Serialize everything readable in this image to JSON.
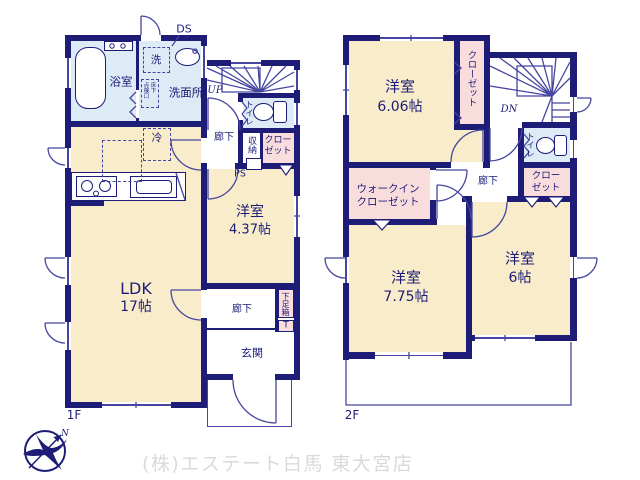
{
  "meta": {
    "floor1_label": "1F",
    "floor2_label": "2F"
  },
  "colors": {
    "wall": "#1d1d78",
    "room_cream": "#f8ecca",
    "wet_blue": "#dcebf6",
    "closet_pink": "#f9dddd",
    "thin_line": "#4646a0",
    "footer_gray": "#dadada"
  },
  "f1": {
    "bath": "浴室",
    "washer": "洗",
    "washroom": "洗面所",
    "duct": "DS",
    "insp_col_left": "点検口",
    "insp_col_right": "床下",
    "stairs_up": "UP",
    "toilet": "トイレ",
    "hall_upper": "廊下",
    "storage": "収納",
    "closet_line1": "クロー",
    "closet_line2": "ゼット",
    "pipe_space": "PS",
    "fridge": "冷",
    "ldk_name": "LDK",
    "ldk_size": "17帖",
    "bedroom_name": "洋室",
    "bedroom_size": "4.37帖",
    "hall_lower": "廊下",
    "shoe_box": "下足箱",
    "shoe_tall": "T",
    "entrance": "玄関"
  },
  "f2": {
    "bedroom1_name": "洋室",
    "bedroom1_size": "6.06帖",
    "closet_vertical": "クローゼット",
    "stairs_down": "DN",
    "toilet": "トイレ",
    "hall": "廊下",
    "closet2_line1": "クロー",
    "closet2_line2": "ゼット",
    "wic_line1": "ウォークイン",
    "wic_line2": "クローゼット",
    "bedroom2_name": "洋室",
    "bedroom2_size": "7.75帖",
    "bedroom3_name": "洋室",
    "bedroom3_size": "6帖"
  },
  "footer": {
    "company": "(株)エステート白馬 東大宮店",
    "compass_n": "N"
  }
}
